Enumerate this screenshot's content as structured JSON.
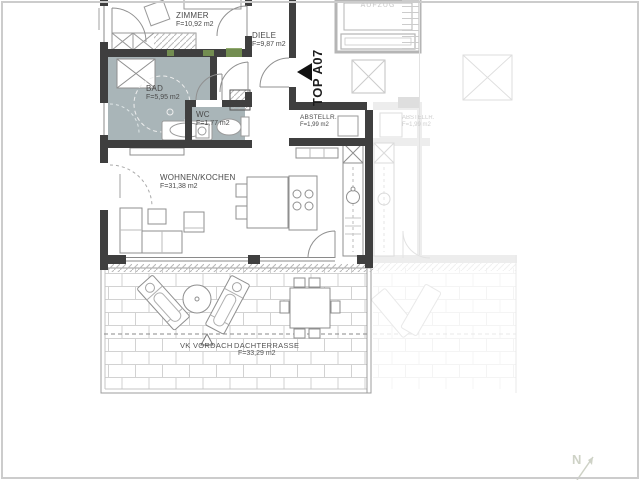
{
  "floor_plan": {
    "unit": {
      "label": "TOP A07"
    },
    "rooms": {
      "zimmer": {
        "name": "ZIMMER",
        "area": "F=10,92 m2"
      },
      "diele": {
        "name": "DIELE",
        "area": "F=9,87 m2"
      },
      "bad": {
        "name": "BAD",
        "area": "F=5,95 m2"
      },
      "wc": {
        "name": "WC",
        "area": "F=1,77 m2"
      },
      "wohnen_kochen": {
        "name": "WOHNEN/KOCHEN",
        "area": "F=31,38 m2"
      },
      "abstellraum": {
        "name": "ABSTELLR.",
        "area": "F=1,99 m2"
      },
      "dachterrasse": {
        "name": "DACHTERRASSE",
        "area": "F=33,29 m2"
      }
    },
    "annotations": {
      "aufzug": "AUFZUG",
      "vk_vordach": "VK VORDACH",
      "north": "N",
      "neighbor_abstellraum": "ABSTELLR.",
      "neighbor_abstellraum_area": "F=1,99 m2"
    },
    "colors": {
      "wall": "#3f3f3f",
      "wet_room_fill": "#a9b5b8",
      "accent_green": "#7d9b55",
      "brick_line": "#d2d2d2",
      "entry_marker": "#111111",
      "label_text": "#4a4a4a",
      "faint_neighbor": "#c7c7c7"
    }
  }
}
